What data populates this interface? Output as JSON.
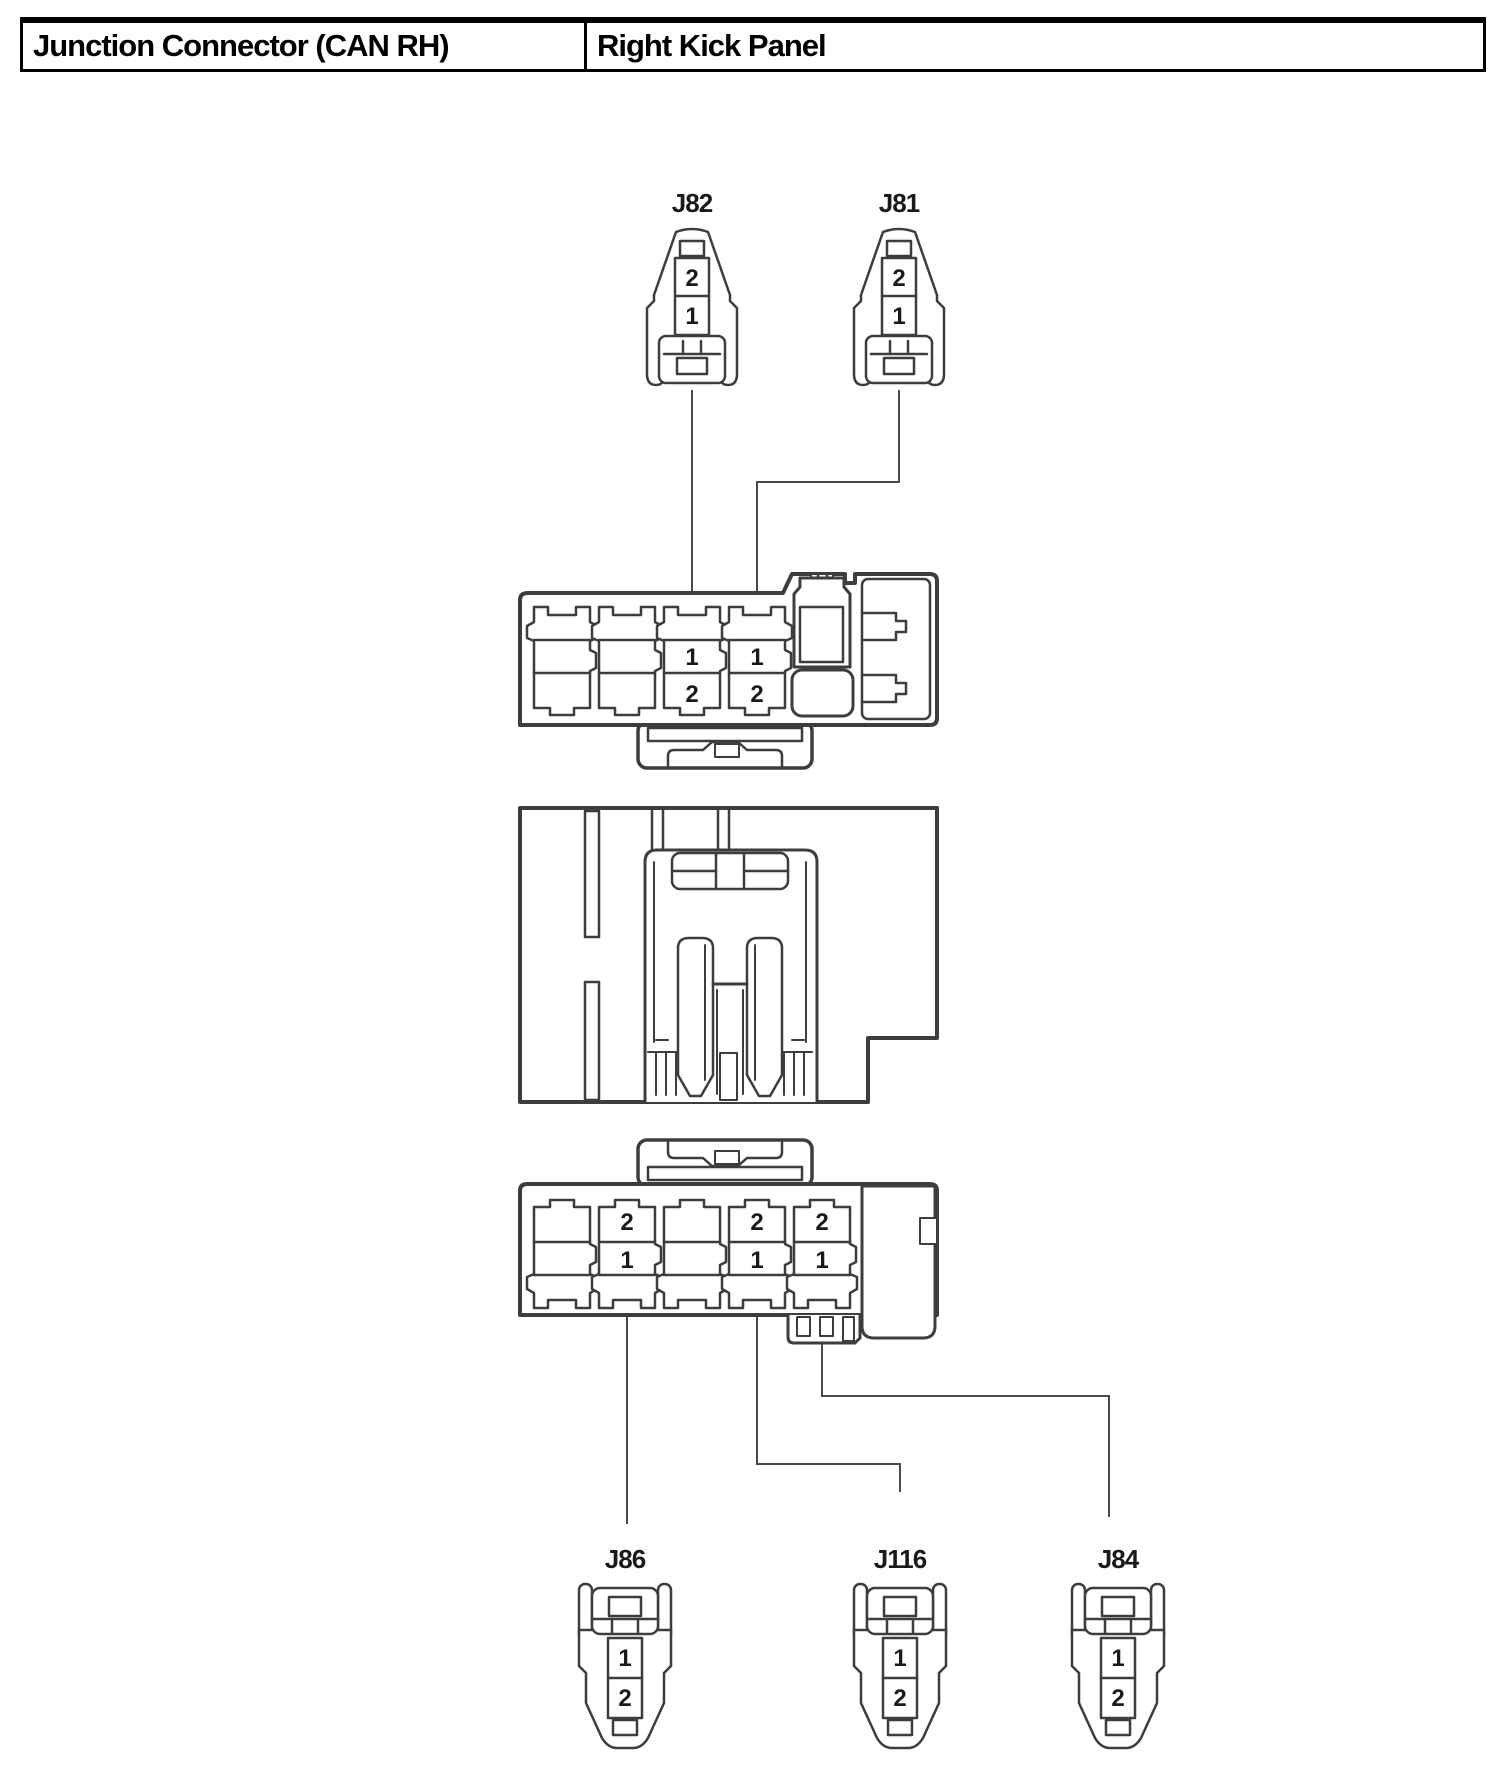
{
  "header": {
    "left_title": "Junction Connector (CAN RH)",
    "right_title": "Right Kick Panel"
  },
  "connectors": {
    "j82": {
      "label": "J82",
      "pin_top": "2",
      "pin_bottom": "1"
    },
    "j81": {
      "label": "J81",
      "pin_top": "2",
      "pin_bottom": "1"
    },
    "j86": {
      "label": "J86",
      "pin_top": "1",
      "pin_bottom": "2"
    },
    "j116": {
      "label": "J116",
      "pin_top": "1",
      "pin_bottom": "2"
    },
    "j84": {
      "label": "J84",
      "pin_top": "1",
      "pin_bottom": "2"
    }
  },
  "upper_block": {
    "cavity3": {
      "pin_top": "1",
      "pin_bottom": "2"
    },
    "cavity4": {
      "pin_top": "1",
      "pin_bottom": "2"
    }
  },
  "lower_block": {
    "cavity2": {
      "pin_top": "2",
      "pin_bottom": "1"
    },
    "cavity4": {
      "pin_top": "2",
      "pin_bottom": "1"
    },
    "cavity5": {
      "pin_top": "2",
      "pin_bottom": "1"
    }
  },
  "colors": {
    "outline": "#3d3d3d",
    "leader": "#4a4a4a",
    "text": "#1a1a1a",
    "background": "#ffffff"
  }
}
